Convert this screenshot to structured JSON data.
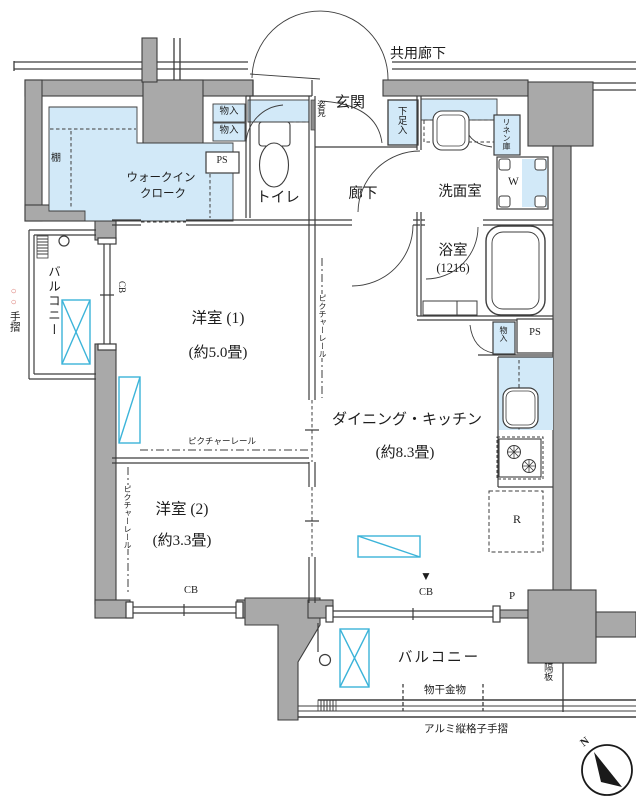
{
  "title": "マンション間取り図",
  "colors": {
    "wall_gray": "#a9a9a9",
    "highlight_blue": "#d2e9f8",
    "ac_cyan": "#3cb4d9",
    "line_dark": "#3d3d3d",
    "handrail_red": "#d9726b"
  },
  "labels": {
    "kyoyo_roka": "共用廊下",
    "genkan": "玄関",
    "sugatami": "姿見",
    "geta": "下足入",
    "mono_top1": "物入",
    "mono_top2": "物入",
    "ps_top": "PS",
    "toilet": "トイレ",
    "tana": "棚",
    "wic1": "ウォークイン",
    "wic2": "クローク",
    "roka": "廊下",
    "senmen": "洗面室",
    "linen": "リネン庫",
    "w": "W",
    "yokushitsu": "浴室",
    "yokushitsu_size": "(1216)",
    "mono_lower": "物入",
    "ps_lower": "PS",
    "room1": "洋室 (1)",
    "room1_size": "(約5.0畳)",
    "room2": "洋室 (2)",
    "room2_size": "(約3.3畳)",
    "dk": "ダイニング・キッチン",
    "dk_size": "(約8.3畳)",
    "r": "R",
    "p": "P",
    "rail_a": "ピクチャーレール",
    "rail_b": "ピクチャーレール",
    "rail_c": "ピクチャーレール",
    "cb_a": "CB",
    "cb_b": "CB",
    "cb_c": "CB",
    "marker": "▼",
    "balcony_left": "バルコニー",
    "balcony_bottom": "バルコニー",
    "tesuri_circles": "○○",
    "tesuri": "手摺",
    "monohoshi": "物干金物",
    "almi": "アルミ縦格子手摺",
    "kakuita": "隔板",
    "north": "N"
  }
}
